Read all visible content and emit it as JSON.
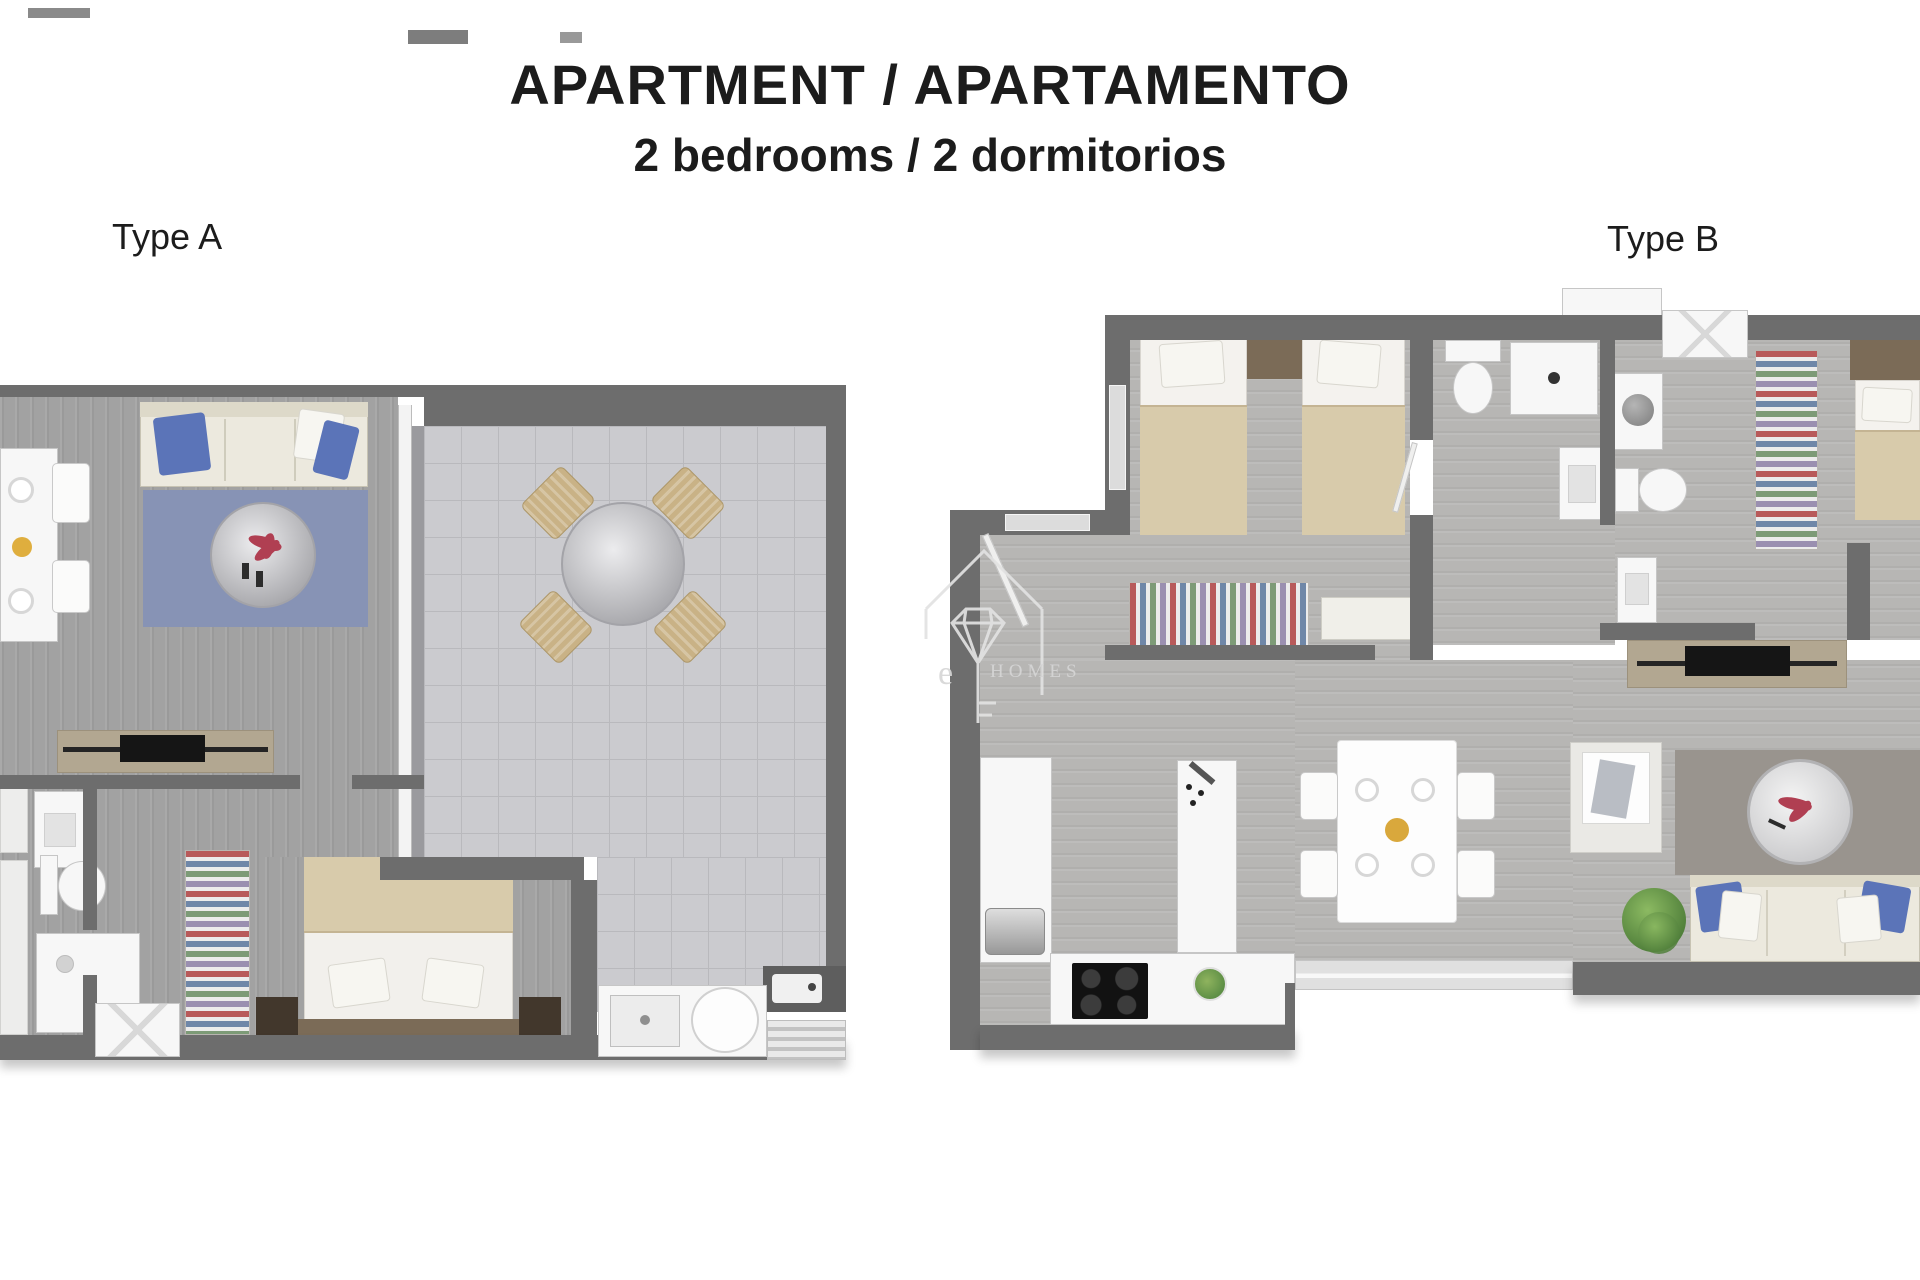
{
  "header": {
    "title": "APARTMENT / APARTAMENTO",
    "subtitle": "2 bedrooms / 2 dormitorios"
  },
  "plans": [
    {
      "id": "type-a",
      "label": "Type A",
      "rooms": [
        "living-room",
        "terrace",
        "bedroom",
        "bathroom",
        "kitchen-strip",
        "hallway"
      ],
      "furniture": [
        "dining-table",
        "dining-chairs",
        "sofa",
        "blue-rug",
        "round-coffee-table",
        "tv-console",
        "double-bed",
        "nightstands",
        "wardrobe",
        "toilet",
        "washbasin",
        "shower",
        "terrace-round-table",
        "terrace-chairs",
        "ac-unit",
        "kitchen-sink",
        "round-basin",
        "drying-rack"
      ]
    },
    {
      "id": "type-b",
      "label": "Type B",
      "rooms": [
        "twin-bedroom",
        "bathroom-1",
        "bathroom-2",
        "master-bedroom",
        "open-kitchen",
        "dining-area",
        "living-area",
        "hallway"
      ],
      "furniture": [
        "twin-beds",
        "wardrobes",
        "bench",
        "toilets",
        "showers",
        "washbasins",
        "fridge",
        "cooktop",
        "kitchen-island",
        "salad-bowl",
        "dining-table",
        "dining-chairs",
        "wall-niche",
        "accent-wall-mirror",
        "sofa",
        "plant",
        "tv-console",
        "entry-door"
      ]
    }
  ],
  "watermark": {
    "prefix": "e",
    "word": "homes"
  },
  "colors": {
    "wall": "#6d6d6d",
    "floor_wood_a": "#a2a2a2",
    "floor_wood_b": "#b7b6b4",
    "floor_tile": "#cbcbcf",
    "rug_blue": "#8793b5",
    "cushion_blue": "#5b74b8",
    "sofa_cream": "#ece9de",
    "bed_beige": "#d8cbab",
    "console_tan": "#b2a791",
    "accent_wall": "#99948e",
    "headboard_brown": "#7b6b57",
    "nightstand_brown": "#42372c",
    "wicker": "#c9b286",
    "fixture_white": "#f7f7f7",
    "text_dark": "#1c1c1c",
    "watermark_gray": "#d6d6d6"
  }
}
